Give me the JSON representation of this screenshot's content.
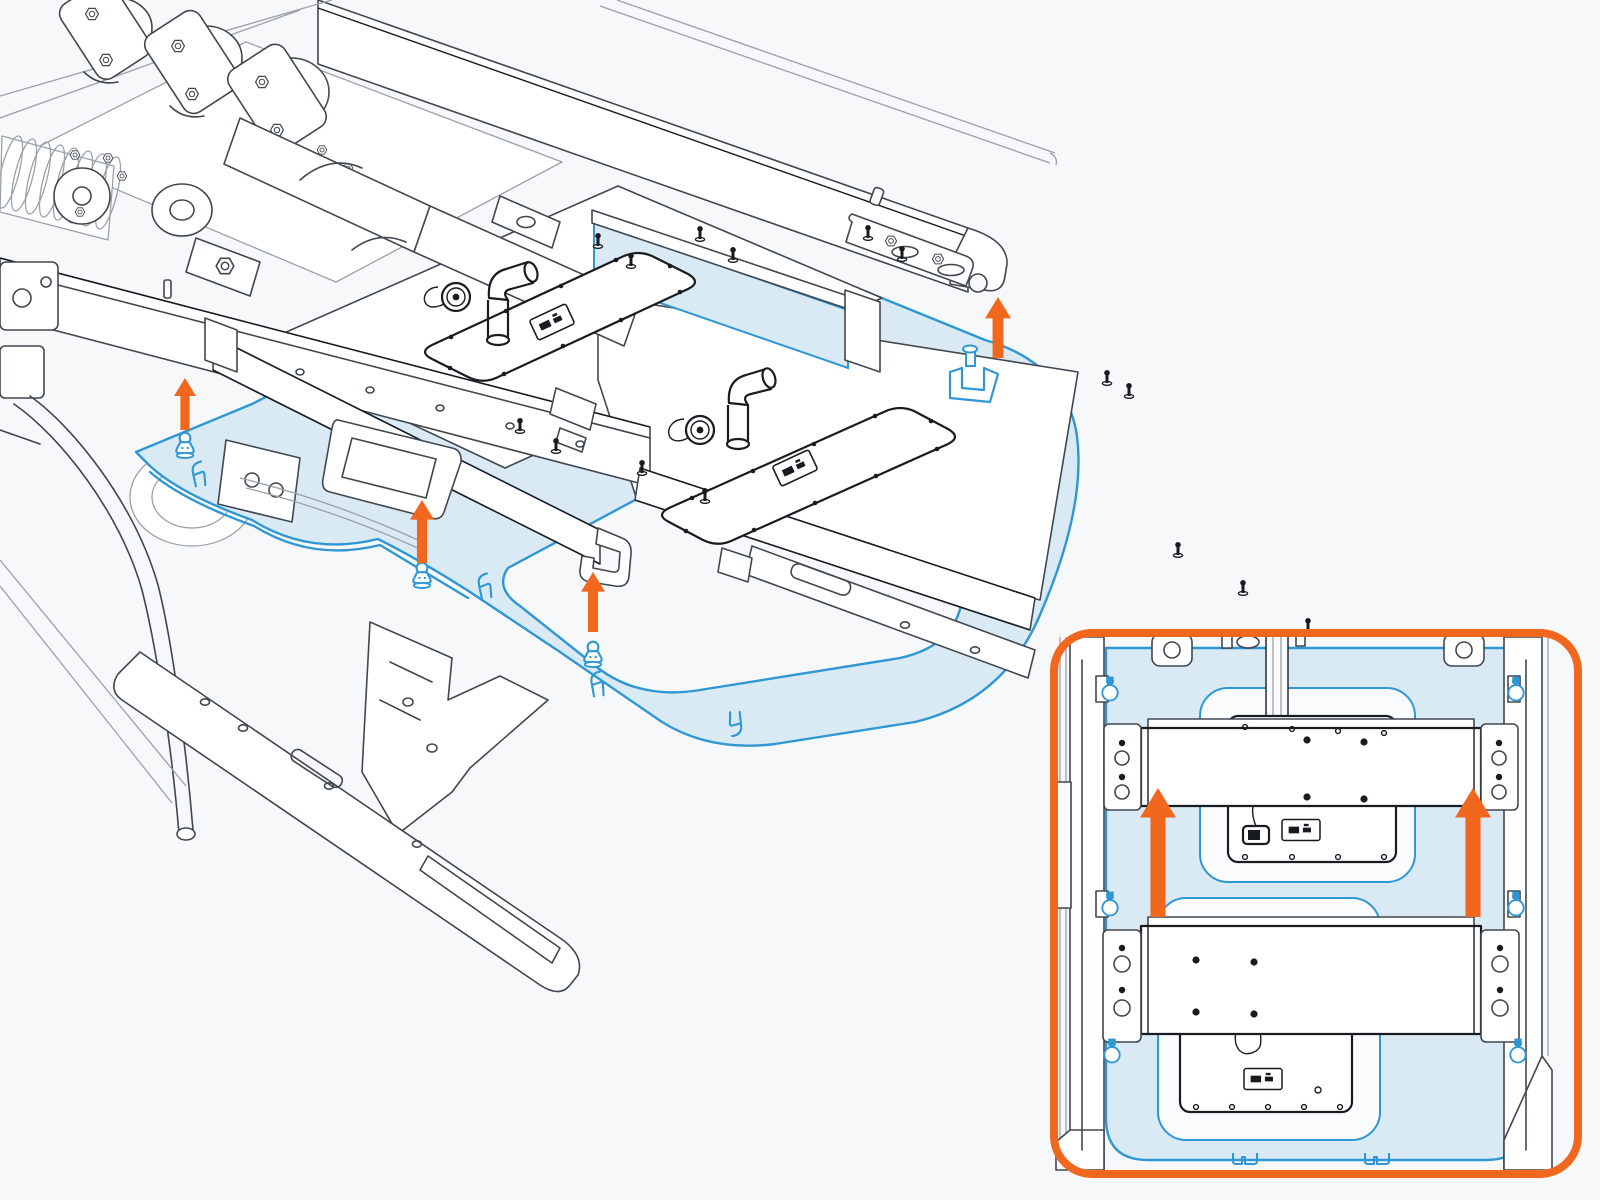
{
  "meta": {
    "description": "Technical installation diagram: underbody skid plate and battery shield mounted upward to a vehicle chassis, with a top-view detail inset",
    "background": "#f7f8f9"
  },
  "palette": {
    "bg": "#f7f8f9",
    "line": "#414750",
    "line_light": "#9aa1a9",
    "dark": "#181b20",
    "blue": "#2f97d4",
    "blue_fill": "#daeaf5",
    "orange": "#f2671e",
    "white": "#ffffff"
  },
  "main_view": {
    "name": "isometric-underbody-view",
    "arrows_up": [
      {
        "x": 185,
        "y_tip": 378,
        "y_tail": 430,
        "w": 22
      },
      {
        "x": 422,
        "y_tip": 500,
        "y_tail": 563,
        "w": 24
      },
      {
        "x": 593,
        "y_tip": 572,
        "y_tail": 632,
        "w": 24
      },
      {
        "x": 998,
        "y_tip": 297,
        "y_tail": 358,
        "w": 26
      }
    ],
    "pushpins": [
      {
        "x": 185,
        "y": 446
      },
      {
        "x": 422,
        "y": 576
      },
      {
        "x": 593,
        "y": 655
      }
    ],
    "corner_bracket": {
      "x": 972,
      "y": 376
    },
    "edge_clips": [
      {
        "x": 197,
        "y": 462,
        "rot": -8
      },
      {
        "x": 483,
        "y": 574,
        "rot": -8
      },
      {
        "x": 596,
        "y": 672,
        "rot": -6
      },
      {
        "x": 888,
        "y": 620,
        "rot": 170
      },
      {
        "x": 1013,
        "y": 524,
        "rot": 150
      },
      {
        "x": 736,
        "y": 736,
        "rot": 178
      }
    ],
    "screws": [
      {
        "x": 598,
        "y": 243
      },
      {
        "x": 631,
        "y": 263
      },
      {
        "x": 700,
        "y": 236
      },
      {
        "x": 733,
        "y": 257
      },
      {
        "x": 868,
        "y": 235
      },
      {
        "x": 902,
        "y": 256
      },
      {
        "x": 520,
        "y": 428
      },
      {
        "x": 556,
        "y": 448
      },
      {
        "x": 642,
        "y": 470
      },
      {
        "x": 705,
        "y": 498
      },
      {
        "x": 1107,
        "y": 380
      },
      {
        "x": 1129,
        "y": 393
      },
      {
        "x": 1178,
        "y": 552
      },
      {
        "x": 1243,
        "y": 590
      },
      {
        "x": 1308,
        "y": 628
      },
      {
        "x": 1192,
        "y": 678
      },
      {
        "x": 1258,
        "y": 710
      },
      {
        "x": 1324,
        "y": 742
      }
    ],
    "labels": [
      {
        "x": 552,
        "y": 322,
        "rot": -25
      },
      {
        "x": 795,
        "y": 468,
        "rot": -25
      }
    ]
  },
  "inset": {
    "name": "top-view-detail-inset",
    "frame": {
      "x": 1054,
      "y": 633,
      "w": 524,
      "h": 541,
      "rx": 38,
      "stroke_width": 8
    },
    "arrows_up": [
      {
        "x": 1158,
        "y_tip": 788,
        "y_tail": 917,
        "w": 36
      },
      {
        "x": 1473,
        "y_tip": 788,
        "y_tail": 917,
        "w": 36
      }
    ],
    "pushpins_top": [
      {
        "x": 1110,
        "y": 690
      },
      {
        "x": 1516,
        "y": 690
      },
      {
        "x": 1110,
        "y": 905
      },
      {
        "x": 1516,
        "y": 905
      },
      {
        "x": 1112,
        "y": 1052
      },
      {
        "x": 1518,
        "y": 1052
      }
    ],
    "bolt_dots": [
      {
        "x": 1307,
        "y": 740
      },
      {
        "x": 1364,
        "y": 742
      },
      {
        "x": 1307,
        "y": 797
      },
      {
        "x": 1364,
        "y": 799
      },
      {
        "x": 1196,
        "y": 960
      },
      {
        "x": 1254,
        "y": 962
      },
      {
        "x": 1196,
        "y": 1012
      },
      {
        "x": 1254,
        "y": 1014
      }
    ],
    "panel_screws": [
      {
        "x": 1245,
        "y": 727
      },
      {
        "x": 1292,
        "y": 729
      },
      {
        "x": 1338,
        "y": 731
      },
      {
        "x": 1384,
        "y": 733
      },
      {
        "x": 1245,
        "y": 857
      },
      {
        "x": 1292,
        "y": 857
      },
      {
        "x": 1338,
        "y": 857
      },
      {
        "x": 1384,
        "y": 857
      },
      {
        "x": 1196,
        "y": 1107
      },
      {
        "x": 1232,
        "y": 1107
      },
      {
        "x": 1268,
        "y": 1107
      },
      {
        "x": 1304,
        "y": 1107
      },
      {
        "x": 1340,
        "y": 1107
      }
    ],
    "labels": [
      {
        "x": 1301,
        "y": 830,
        "rot": 0
      },
      {
        "x": 1263,
        "y": 1079,
        "rot": 0
      }
    ],
    "plate_tabs": [
      {
        "x": 1246,
        "y": 1153
      },
      {
        "x": 1378,
        "y": 1153
      }
    ]
  }
}
